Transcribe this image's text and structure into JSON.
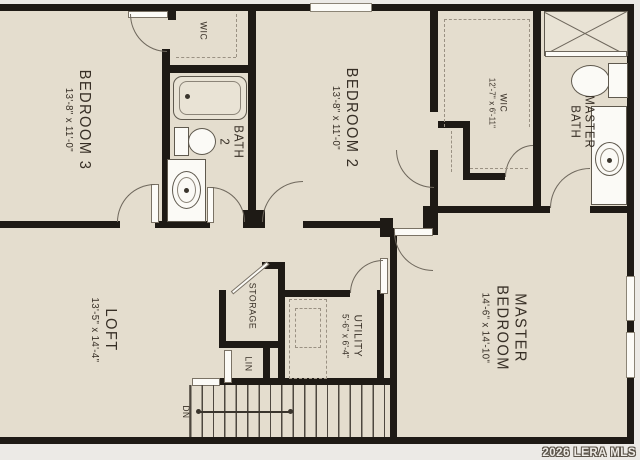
{
  "plan": {
    "rooms": {
      "bedroom3": {
        "name": "BEDROOM 3",
        "dims": "13'-8\" x 11'-0\""
      },
      "bedroom2": {
        "name": "BEDROOM 2",
        "dims": "13'-8\" x 11'-0\""
      },
      "master_bedroom": {
        "name": "MASTER",
        "name2": "BEDROOM",
        "dims": "14'-6\" x 14'-10\""
      },
      "loft": {
        "name": "LOFT",
        "dims": "13'-5\" x 14'-4\""
      },
      "wic_bedroom3": {
        "name": "WIC"
      },
      "wic_master": {
        "name": "WIC",
        "dims": "12'-7\" x 6'-11\""
      },
      "bath2": {
        "name": "BATH",
        "name2": "2"
      },
      "master_bath": {
        "name": "MASTER",
        "name2": "BATH"
      },
      "storage": {
        "name": "STORAGE"
      },
      "linen": {
        "name": "LIN"
      },
      "utility": {
        "name": "UTILITY",
        "dims": "5'-6\" x 6'-4\""
      },
      "stairs": {
        "label": "DN"
      }
    },
    "watermark": "2026 LERA MLS",
    "colors": {
      "floor": "#e4ddce",
      "wall": "#1e1a15",
      "background": "#eceae6",
      "thin_line": "#6e675c",
      "text": "#372f26"
    }
  }
}
